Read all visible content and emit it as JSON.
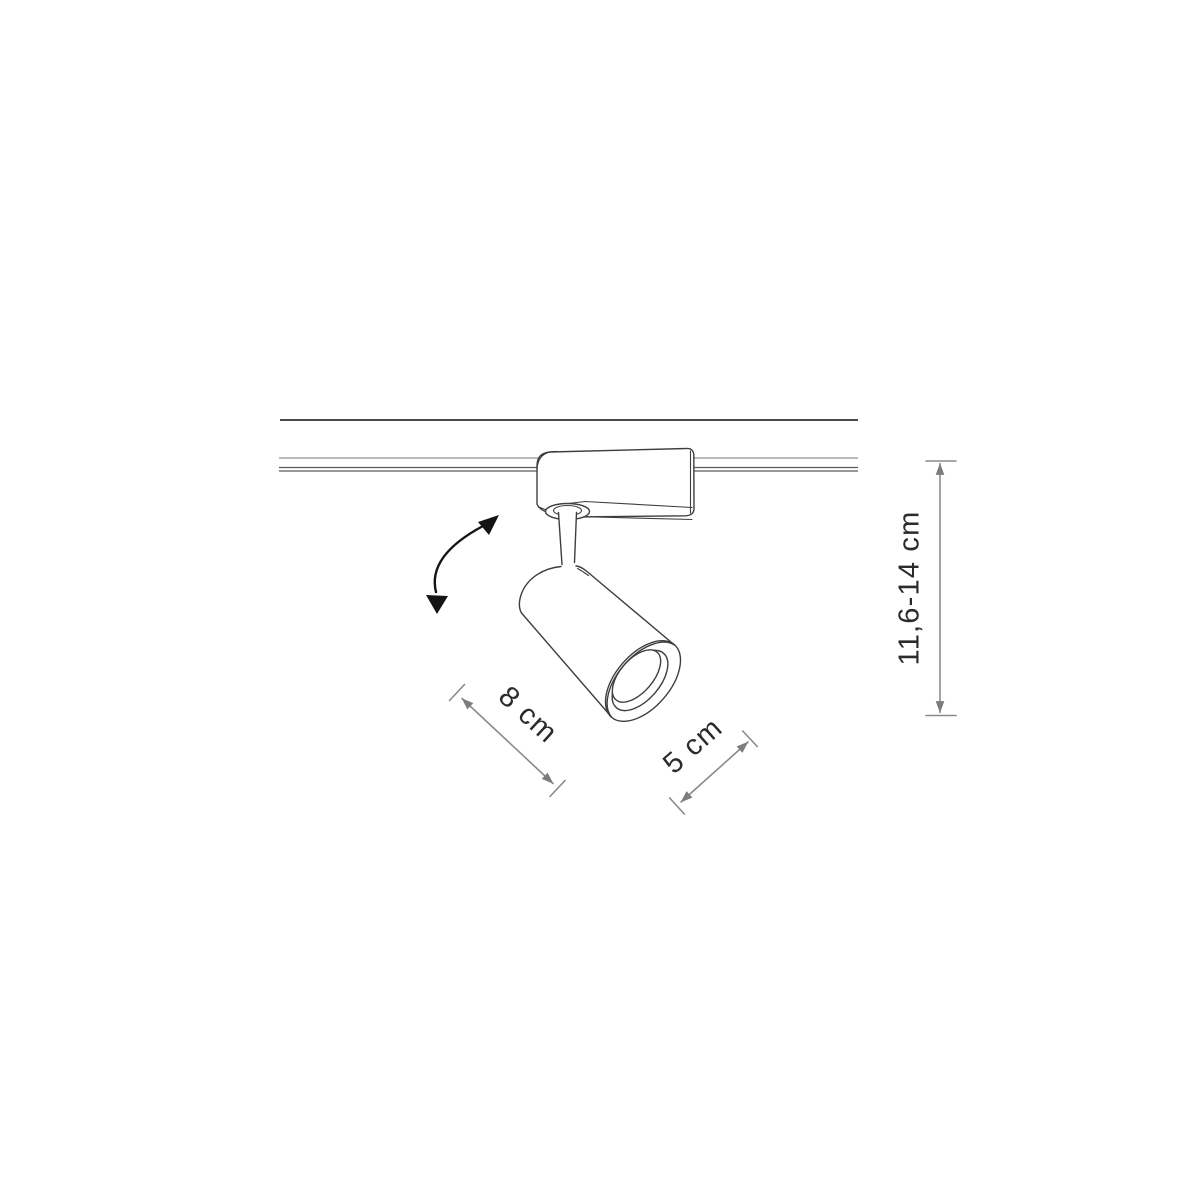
{
  "page": {
    "subject": "Technical dimension drawing of an adjustable track-mounted spotlight",
    "background": "#ffffff"
  },
  "colors": {
    "outline": "#3e3e3e",
    "ceiling": "#303030",
    "track": "#5a5a5a",
    "tracklight": "#7a7a7a",
    "dim": "#8a8a8a",
    "dimhead": "#7d7d7d",
    "ink": "#2b2b2b",
    "arrow": "#141414",
    "bg": "#ffffff"
  },
  "diagram": {
    "labels": {
      "length": "8 cm",
      "diameter": "5 cm",
      "height": "11,6-14 cm"
    },
    "icons": {
      "rotation_arrow": "curved-double-headed-arrow"
    }
  }
}
